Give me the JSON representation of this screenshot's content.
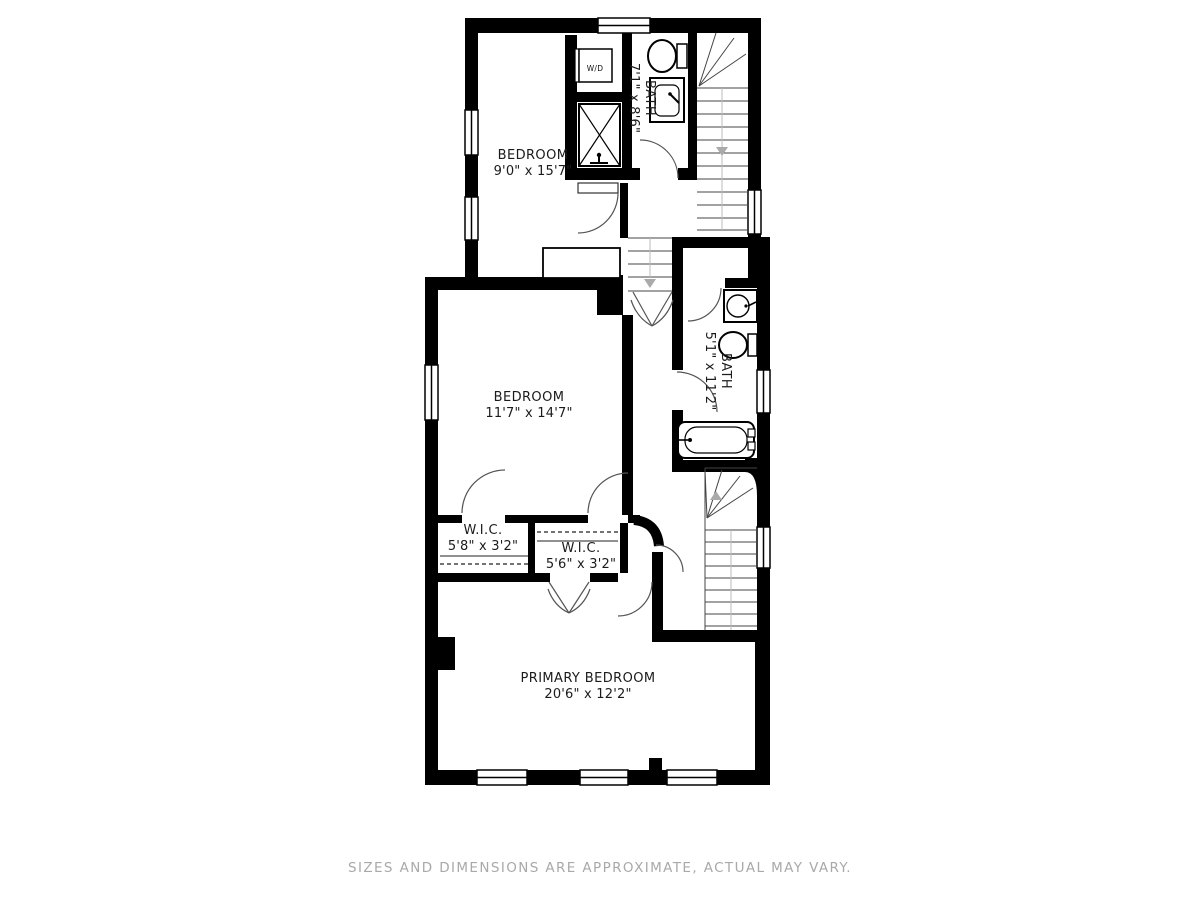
{
  "floor_plan": {
    "rooms": {
      "bedroom_top": {
        "name": "BEDROOM",
        "dims": "9'0\" x 15'7\""
      },
      "bath_top": {
        "name": "BATH",
        "dims": "7'1\" x 8'6\""
      },
      "bedroom_mid": {
        "name": "BEDROOM",
        "dims": "11'7\" x 14'7\""
      },
      "bath_mid": {
        "name": "BATH",
        "dims": "5'1\" x 11'2\""
      },
      "wic_left": {
        "name": "W.I.C.",
        "dims": "5'8\" x 3'2\""
      },
      "wic_mid": {
        "name": "W.I.C.",
        "dims": "5'6\" x 3'2\""
      },
      "primary": {
        "name": "PRIMARY BEDROOM",
        "dims": "20'6\" x 12'2\""
      }
    },
    "fixtures": {
      "washer_dryer": "W/D"
    },
    "colors": {
      "wall": "#000000",
      "thin_line": "#444444",
      "stair_line": "#777777",
      "muted": "#aaaaaa"
    }
  },
  "footer": {
    "disclaimer": "SIZES AND DIMENSIONS ARE APPROXIMATE, ACTUAL MAY VARY."
  }
}
